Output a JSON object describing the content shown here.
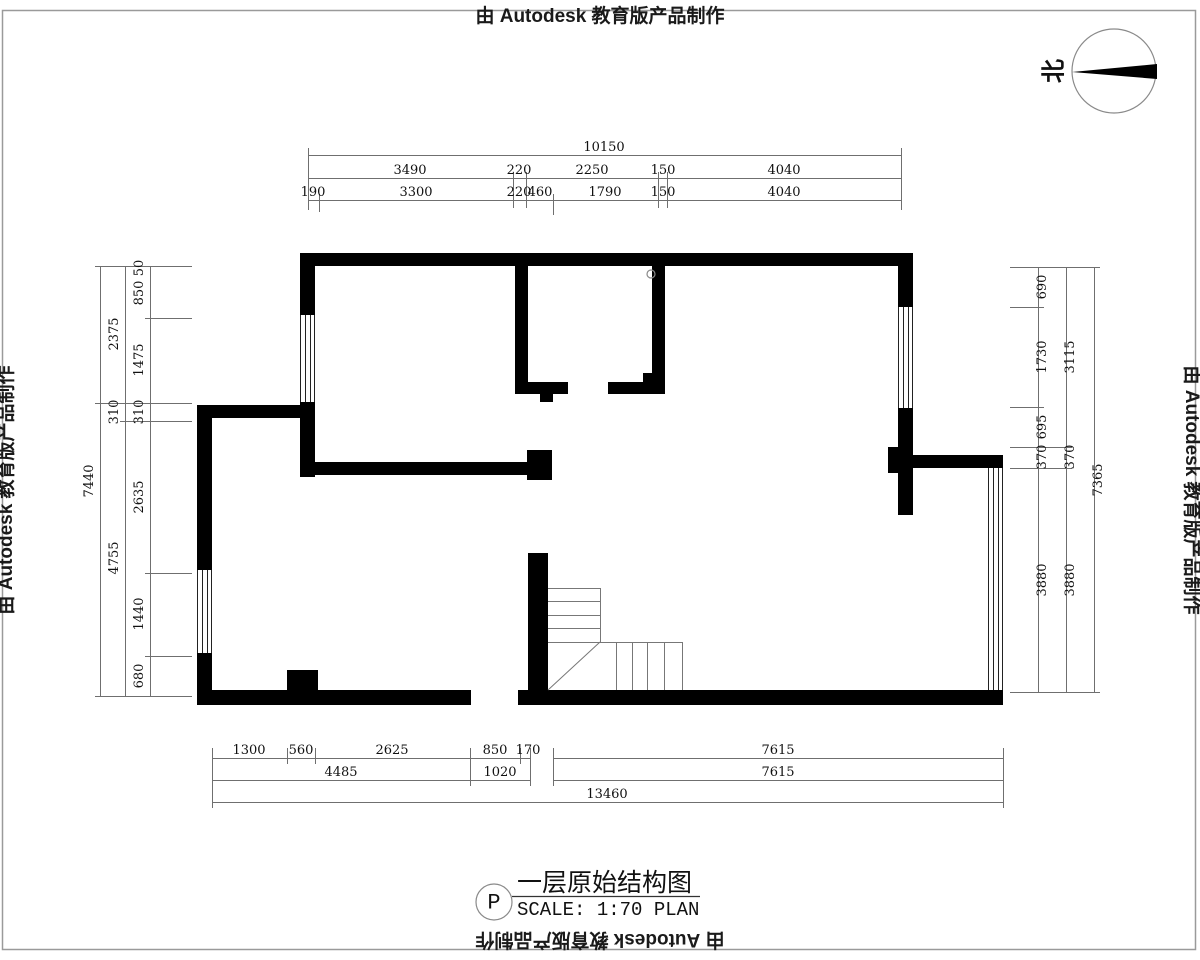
{
  "colors": {
    "wall": "#000000",
    "dim_line": "#6f6f6f",
    "dim_text": "#111111",
    "border": "#9a9a9a",
    "stair_line": "#777777"
  },
  "stamps": {
    "top": "由 Autodesk 教育版产品制作",
    "left": "由 Autodesk 教育版产品制作",
    "right": "由 Autodesk 教育版产品制作",
    "bottom": "由 Autodesk 教育版产品制作"
  },
  "north_arrow": {
    "label": "北"
  },
  "title_block": {
    "tag": "P",
    "title": "一层原始结构图",
    "scale_label": "SCALE: 1:70 PLAN"
  },
  "dimensions": {
    "top": {
      "overall": 10150,
      "row2": [
        3490,
        220,
        2250,
        150,
        4040
      ],
      "row3": [
        190,
        3300,
        220,
        460,
        1790,
        150,
        4040
      ]
    },
    "left": {
      "inner": [
        50,
        850,
        1475,
        310,
        2635,
        1440,
        680
      ],
      "middle": [
        2375,
        310,
        4755
      ],
      "overall": 7440
    },
    "right": {
      "inner": [
        690,
        1730,
        695,
        370,
        3880
      ],
      "middle": [
        3115,
        370,
        3880
      ],
      "overall": 7365
    },
    "bottom": {
      "row1_left": [
        1300,
        560,
        2625,
        850,
        170
      ],
      "row1_right": 7615,
      "row2_left": [
        4485,
        1020
      ],
      "row2_right": 7615,
      "overall": 13460
    }
  }
}
